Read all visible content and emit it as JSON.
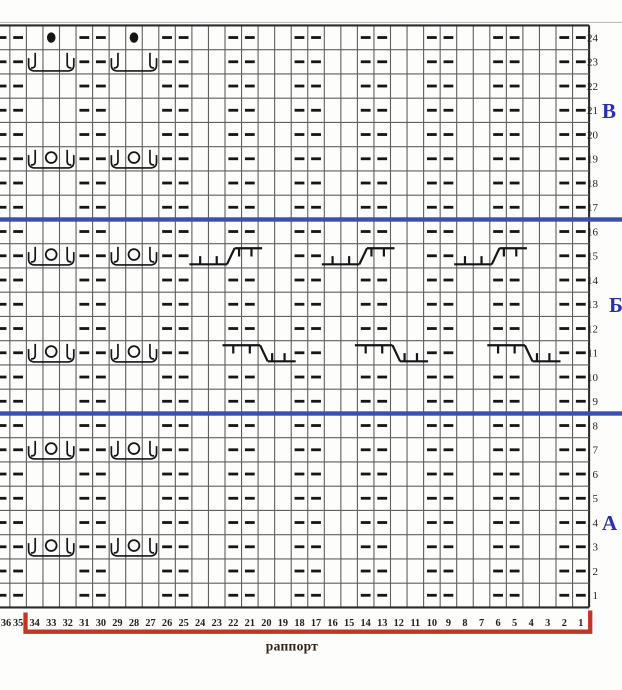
{
  "chart": {
    "type": "knitting-pattern-chart",
    "rows": 24,
    "columns": 36,
    "row_labels": [
      "24",
      "23",
      "22",
      "21",
      "20",
      "19",
      "18",
      "17",
      "16",
      "15",
      "14",
      "13",
      "12",
      "11",
      "10",
      "9",
      "8",
      "7",
      "6",
      "5",
      "4",
      "3",
      "2",
      "1"
    ],
    "col_labels": [
      "36",
      "35",
      "34",
      "33",
      "32",
      "31",
      "30",
      "29",
      "28",
      "27",
      "26",
      "25",
      "24",
      "23",
      "22",
      "21",
      "20",
      "19",
      "18",
      "17",
      "16",
      "15",
      "14",
      "13",
      "12",
      "11",
      "10",
      "9",
      "8",
      "7",
      "6",
      "5",
      "4",
      "3",
      "2",
      "1"
    ],
    "section_letters": [
      {
        "label": "В",
        "row": 21
      },
      {
        "label": "Б",
        "row": 13
      },
      {
        "label": "А",
        "row": 4
      }
    ],
    "purl_dash_columns": [
      36,
      35,
      31,
      30,
      26,
      25,
      22,
      21,
      18,
      17,
      14,
      13,
      10,
      9,
      6,
      5,
      2,
      1
    ],
    "dot_cells": [
      {
        "row": 24,
        "col": 33
      },
      {
        "row": 24,
        "col": 28
      }
    ],
    "cluster_symbols": {
      "col_starts": [
        34,
        29
      ],
      "span_cols": 3,
      "rows": [
        {
          "row": 23,
          "circle": false
        },
        {
          "row": 19,
          "circle": true
        },
        {
          "row": 15,
          "circle": true
        },
        {
          "row": 11,
          "circle": true
        },
        {
          "row": 7,
          "circle": true
        },
        {
          "row": 3,
          "circle": true
        }
      ]
    },
    "cable_symbols": [
      {
        "row": 15,
        "direction": "right_cross",
        "span_cols": 4,
        "col_starts": [
          24,
          16,
          8
        ]
      },
      {
        "row": 11,
        "direction": "left_cross",
        "span_cols": 4,
        "col_starts": [
          22,
          14,
          6
        ]
      }
    ],
    "section_divider_below_rows": [
      17,
      9
    ],
    "rapport": {
      "label": "раппорт",
      "from_col": 34,
      "to_col": 1
    },
    "colors": {
      "background": "#fdfdfc",
      "grid_line": "#5f5f5f",
      "grid_border": "#2c2c2c",
      "symbol": "#161616",
      "section_line_blue": "#3a50ac",
      "rapport_bracket_red": "#bf3629",
      "section_letter_blue": "#2b2fa8",
      "label_text": "#1f1f1f",
      "rapport_text": "#33221a",
      "top_faint_line": "#b8b8b4"
    }
  }
}
